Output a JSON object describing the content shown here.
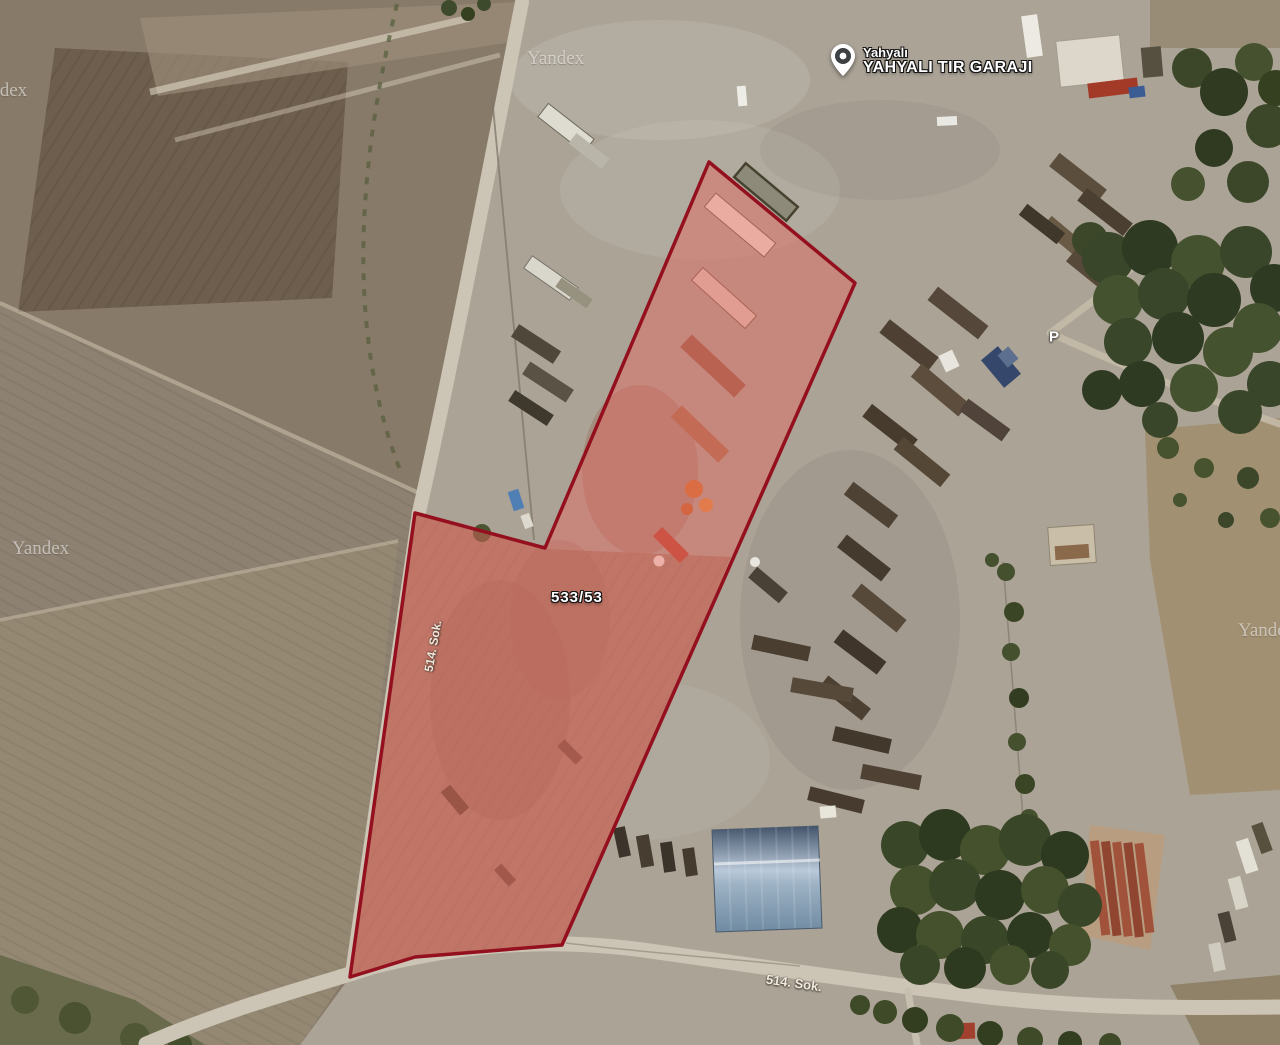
{
  "map": {
    "watermark": "Yandex",
    "place": {
      "locality": "Yahyalı",
      "title": "YAHYALI TIR GARAJI"
    },
    "parcel": {
      "label": "533/53",
      "fill_color": "#e8655a",
      "stroke_color": "#94101f"
    },
    "streets": {
      "west": "514. Sok.",
      "south": "514. Sok."
    },
    "parking": "P"
  }
}
